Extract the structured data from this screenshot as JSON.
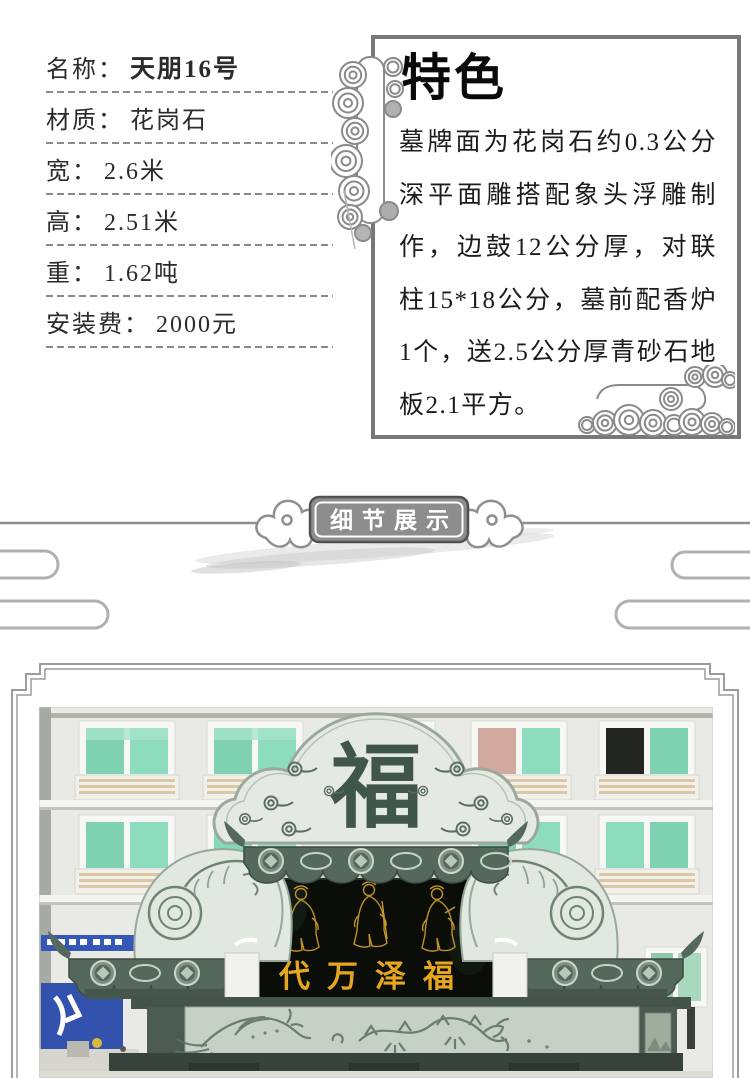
{
  "specs": {
    "items": [
      {
        "label": "名称：",
        "value": "天朋16号"
      },
      {
        "label": "材质：",
        "value": "花岗石"
      },
      {
        "label": "宽：",
        "value": "2.6米"
      },
      {
        "label": "高：",
        "value": "2.51米"
      },
      {
        "label": "重：",
        "value": "1.62吨"
      },
      {
        "label": "安装费：",
        "value": "2000元"
      }
    ]
  },
  "feature": {
    "title": "特色",
    "body": "墓牌面为花岗石约0.3公分深平面雕搭配象头浮雕制作，边鼓12公分厚，对联柱15*18公分，墓前配香炉1个，送2.5公分厚青砂石地板2.1平方。"
  },
  "section_banner": {
    "label": "细节展示"
  },
  "photo": {
    "cloud_character": "福",
    "panel_text": "代万泽福"
  },
  "colors": {
    "accent_gold": "#e6a71e",
    "panel_black": "#0b0d09",
    "stone_dark": "#55685c",
    "stone_light": "#e1e8e0",
    "banner_gray": "#8d8d8d",
    "window_teal": "#7ed2b2",
    "sign_blue": "#3558b8",
    "line_gray": "#8f8f8f"
  }
}
